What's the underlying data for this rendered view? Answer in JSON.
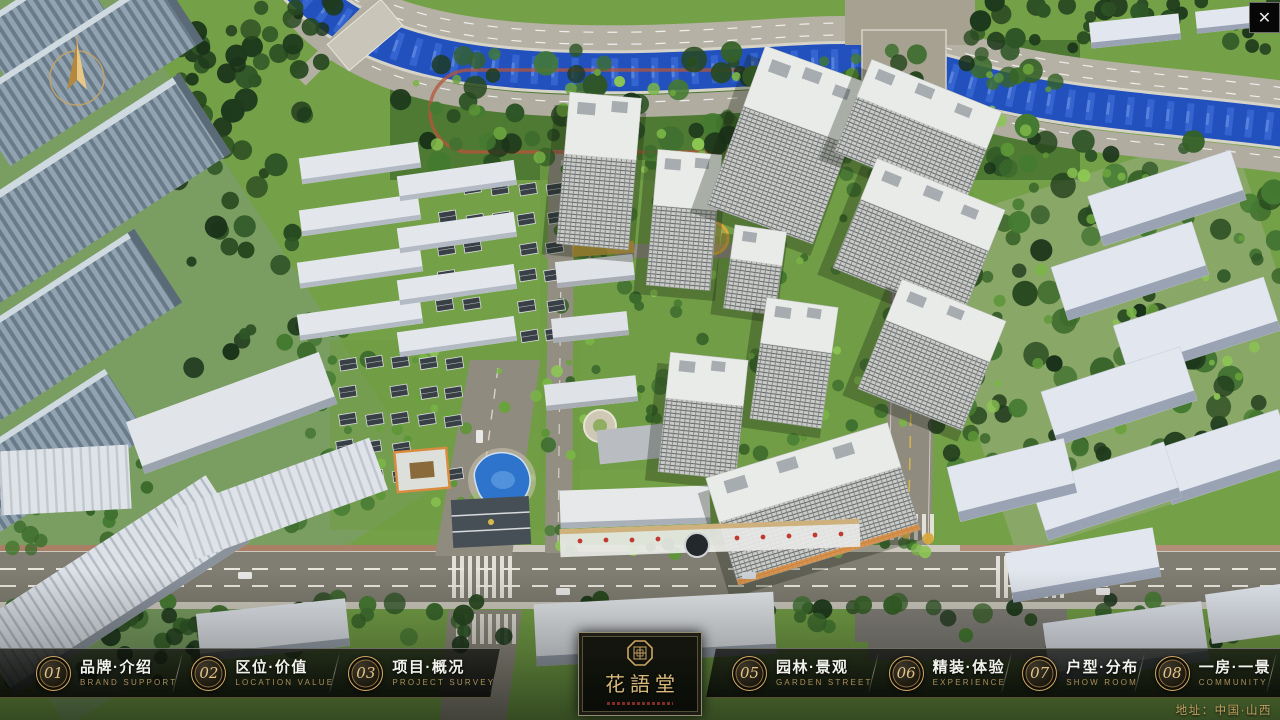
{
  "window": {
    "close_glyph": "✕"
  },
  "menu": {
    "items": [
      {
        "num": "01",
        "zh": "品牌·介绍",
        "en": "BRAND SUPPORT"
      },
      {
        "num": "02",
        "zh": "区位·价值",
        "en": "LOCATION VALUE"
      },
      {
        "num": "03",
        "zh": "项目·概况",
        "en": "PROJECT SURVEY"
      },
      {
        "num": "04",
        "zh": "建筑·鉴赏",
        "en": "APPRECIATION"
      },
      {
        "num": "05",
        "zh": "园林·景观",
        "en": "GARDEN STREET"
      },
      {
        "num": "06",
        "zh": "精装·体验",
        "en": "EXPERIENCE"
      },
      {
        "num": "07",
        "zh": "户型·分布",
        "en": "SHOW ROOM"
      },
      {
        "num": "08",
        "zh": "一房·一景",
        "en": "COMMUNITY"
      }
    ]
  },
  "logo": {
    "title": "花語堂"
  },
  "footer": {
    "address": "地址：中国·山西"
  },
  "colors": {
    "accent_gold": "#c9a464",
    "river_blue": "#2251bd",
    "bar_bg": "#0a0c08"
  }
}
